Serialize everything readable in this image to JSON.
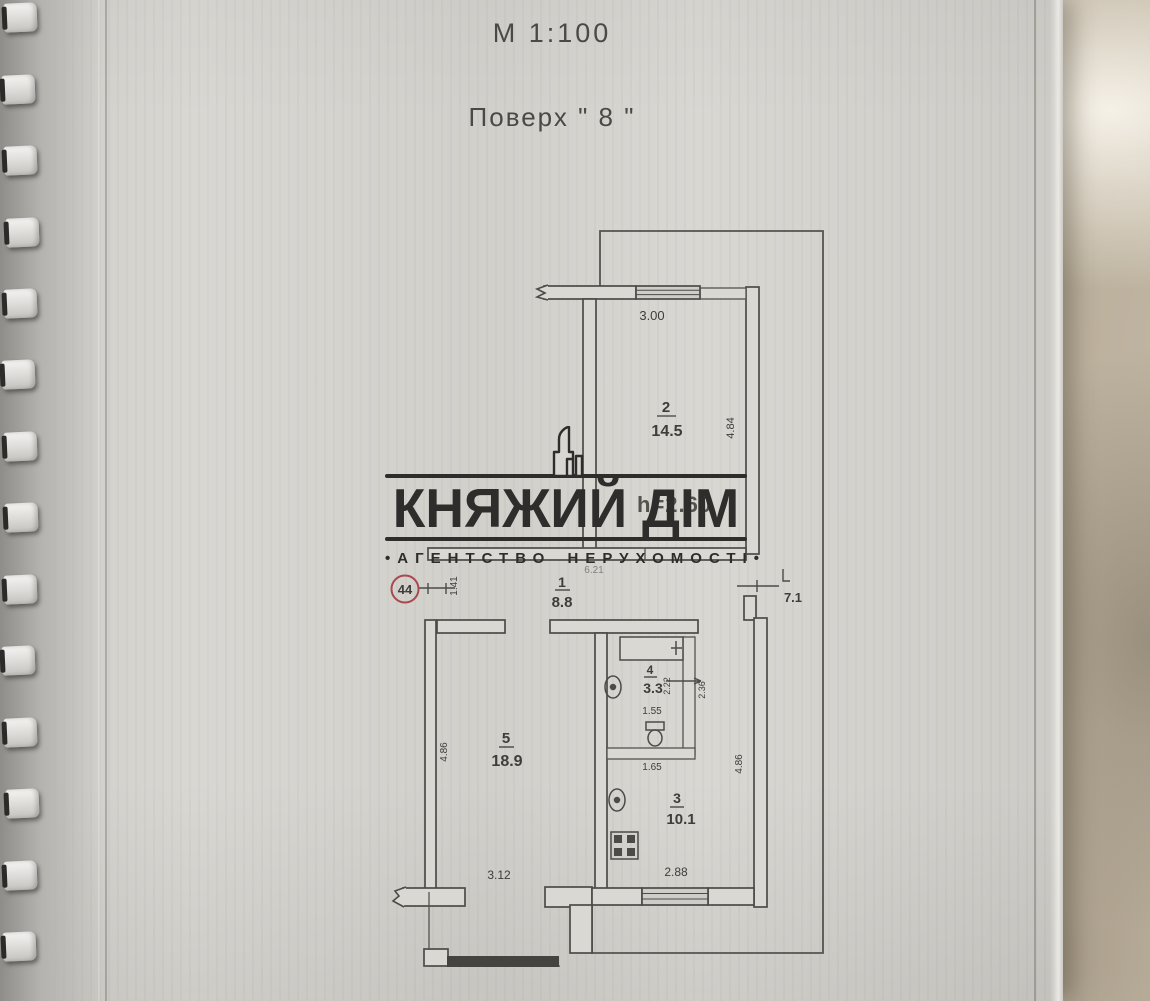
{
  "header": {
    "scale": "М 1:100",
    "floor": "Поверх \" 8 \""
  },
  "watermark": {
    "title": "КНЯЖИЙ ДІМ",
    "subtitle": "АГЕНТСТВО НЕРУХОМОСТІ",
    "bullet": "•"
  },
  "plan": {
    "apartment_number": "44",
    "ceiling_height": "h=2.60",
    "rooms": [
      {
        "number": "1",
        "area": "8.8"
      },
      {
        "number": "2",
        "area": "14.5"
      },
      {
        "number": "3",
        "area": "10.1"
      },
      {
        "number": "4",
        "area": "3.3"
      },
      {
        "number": "5",
        "area": "18.9"
      }
    ],
    "balcony_area": "7.1",
    "dims": {
      "room2_width": "3.00",
      "room2_depth": "4.84",
      "hall_width": "6.21",
      "entry_width": "1.41",
      "bath_width": "2.22",
      "niche_depth": "2.36",
      "bath_len": "1.55",
      "bath_len2": "1.65",
      "room5_depth": "4.86",
      "kitchen_depth": "4.86",
      "room5_width": "3.12",
      "kitchen_width": "2.88"
    }
  }
}
